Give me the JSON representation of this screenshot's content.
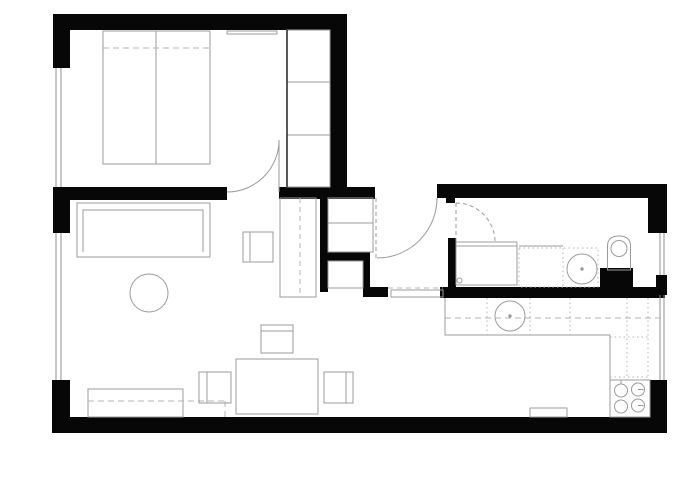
{
  "plan": {
    "canvas": {
      "w": 700,
      "h": 494,
      "bg": "#ffffff"
    },
    "colors": {
      "wall": "#070707",
      "furniture": "#9b9b9b",
      "dashed": "#b4b4b4",
      "dark": "#2e2e2e",
      "window": "#8f8f8f",
      "door": "#9a9a9a"
    },
    "items": [
      {
        "name": "wall-top-bedroom",
        "shapes": [
          {
            "t": "rect",
            "x": 53,
            "y": 14,
            "w": 294,
            "h": 16,
            "f": "wall"
          }
        ]
      },
      {
        "name": "wall-left-upper",
        "shapes": [
          {
            "t": "rect",
            "x": 53,
            "y": 14,
            "w": 17,
            "h": 54,
            "f": "wall"
          }
        ]
      },
      {
        "name": "wall-left-pier",
        "shapes": [
          {
            "t": "rect",
            "x": 53,
            "y": 187,
            "w": 17,
            "h": 46,
            "f": "wall"
          }
        ]
      },
      {
        "name": "wall-left-lower",
        "shapes": [
          {
            "t": "rect",
            "x": 52,
            "y": 380,
            "w": 18,
            "h": 53,
            "f": "wall"
          }
        ]
      },
      {
        "name": "wall-bottom",
        "shapes": [
          {
            "t": "rect",
            "x": 53,
            "y": 417,
            "w": 614,
            "h": 16,
            "f": "wall"
          }
        ]
      },
      {
        "name": "wall-bedroom-right",
        "shapes": [
          {
            "t": "rect",
            "x": 330,
            "y": 14,
            "w": 17,
            "h": 178,
            "f": "wall"
          }
        ]
      },
      {
        "name": "wall-bedroom-bottom-west",
        "shapes": [
          {
            "t": "rect",
            "x": 53,
            "y": 187,
            "w": 174,
            "h": 13,
            "f": "wall"
          }
        ]
      },
      {
        "name": "wall-hall-top-west",
        "shapes": [
          {
            "t": "rect",
            "x": 279,
            "y": 187,
            "w": 96,
            "h": 12,
            "f": "wall"
          }
        ]
      },
      {
        "name": "wall-rightwing-top",
        "shapes": [
          {
            "t": "rect",
            "x": 437,
            "y": 184,
            "w": 230,
            "h": 14,
            "f": "wall"
          }
        ]
      },
      {
        "name": "wall-right-upper",
        "shapes": [
          {
            "t": "rect",
            "x": 648,
            "y": 184,
            "w": 19,
            "h": 49,
            "f": "wall"
          }
        ]
      },
      {
        "name": "wall-right-pier",
        "shapes": [
          {
            "t": "rect",
            "x": 656,
            "y": 275,
            "w": 11,
            "h": 20,
            "f": "wall"
          }
        ]
      },
      {
        "name": "wall-right-lower",
        "shapes": [
          {
            "t": "rect",
            "x": 650,
            "y": 380,
            "w": 17,
            "h": 53,
            "f": "wall"
          }
        ]
      },
      {
        "name": "wall-closet-left",
        "shapes": [
          {
            "t": "rect",
            "x": 320,
            "y": 198,
            "w": 8,
            "h": 94,
            "f": "wall"
          }
        ]
      },
      {
        "name": "wall-closet-mid",
        "shapes": [
          {
            "t": "rect",
            "x": 320,
            "y": 252,
            "w": 50,
            "h": 9,
            "f": "wall"
          }
        ]
      },
      {
        "name": "wall-closet-right",
        "shapes": [
          {
            "t": "rect",
            "x": 363,
            "y": 261,
            "w": 7,
            "h": 27,
            "f": "wall"
          }
        ]
      },
      {
        "name": "wall-closet-stub",
        "shapes": [
          {
            "t": "rect",
            "x": 363,
            "y": 287,
            "w": 25,
            "h": 10,
            "f": "wall"
          }
        ]
      },
      {
        "name": "wall-bathroom-bottom",
        "shapes": [
          {
            "t": "rect",
            "x": 440,
            "y": 287,
            "w": 225,
            "h": 11,
            "f": "wall"
          }
        ]
      },
      {
        "name": "wall-bathroom-left",
        "shapes": [
          {
            "t": "rect",
            "x": 448,
            "y": 238,
            "w": 8,
            "h": 49,
            "f": "wall"
          }
        ]
      },
      {
        "name": "wall-entry-jamb",
        "shapes": [
          {
            "t": "rect",
            "x": 446,
            "y": 195,
            "w": 9,
            "h": 8,
            "f": "wall"
          }
        ]
      },
      {
        "name": "wall-toilet-duct",
        "shapes": [
          {
            "t": "rect",
            "x": 600,
            "y": 268,
            "w": 33,
            "h": 20,
            "f": "wall"
          }
        ]
      },
      {
        "name": "window-bedroom-left",
        "shapes": [
          {
            "t": "line",
            "x1": 56,
            "y1": 68,
            "x2": 56,
            "y2": 187,
            "c": "window"
          },
          {
            "t": "line",
            "x1": 61,
            "y1": 68,
            "x2": 61,
            "y2": 187,
            "c": "window"
          }
        ]
      },
      {
        "name": "window-living-left",
        "shapes": [
          {
            "t": "line",
            "x1": 56,
            "y1": 233,
            "x2": 56,
            "y2": 380,
            "c": "window"
          },
          {
            "t": "line",
            "x1": 61,
            "y1": 233,
            "x2": 61,
            "y2": 380,
            "c": "window"
          }
        ]
      },
      {
        "name": "window-bathroom-right",
        "shapes": [
          {
            "t": "line",
            "x1": 660,
            "y1": 233,
            "x2": 660,
            "y2": 275,
            "c": "window"
          },
          {
            "t": "line",
            "x1": 664,
            "y1": 233,
            "x2": 664,
            "y2": 275,
            "c": "window"
          }
        ]
      },
      {
        "name": "window-kitchen-right",
        "shapes": [
          {
            "t": "line",
            "x1": 660,
            "y1": 295,
            "x2": 660,
            "y2": 380,
            "c": "window"
          },
          {
            "t": "line",
            "x1": 664,
            "y1": 295,
            "x2": 664,
            "y2": 380,
            "c": "window"
          }
        ]
      },
      {
        "name": "door-bedroom",
        "shapes": [
          {
            "t": "path",
            "d": "M227,192 A52,52 0 0 0 279,140",
            "c": "door"
          },
          {
            "t": "line",
            "x1": 279,
            "y1": 140,
            "x2": 279,
            "y2": 192,
            "c": "door"
          }
        ]
      },
      {
        "name": "door-entrance",
        "shapes": [
          {
            "t": "path",
            "d": "M437,198 A60,60 0 0 1 377,258",
            "c": "door"
          },
          {
            "t": "line",
            "x1": 376,
            "y1": 198,
            "x2": 376,
            "y2": 258,
            "c": "door",
            "dash": "4,3"
          }
        ]
      },
      {
        "name": "door-bathroom",
        "shapes": [
          {
            "t": "path",
            "d": "M456,203 A39,39 0 0 1 495,242",
            "c": "door",
            "dash": "4,3"
          },
          {
            "t": "line",
            "x1": 456,
            "y1": 203,
            "x2": 456,
            "y2": 242,
            "c": "door",
            "dash": "4,3"
          }
        ]
      },
      {
        "name": "bed-double",
        "shapes": [
          {
            "t": "rect",
            "x": 103,
            "y": 31,
            "w": 107,
            "h": 133
          },
          {
            "t": "line",
            "x1": 156,
            "y1": 31,
            "x2": 156,
            "y2": 164
          },
          {
            "t": "line",
            "x1": 103,
            "y1": 48,
            "x2": 210,
            "y2": 48,
            "dash": "6,4",
            "c": "dashed"
          }
        ]
      },
      {
        "name": "bedroom-shelf",
        "shapes": [
          {
            "t": "rect",
            "x": 227,
            "y": 31,
            "w": 50,
            "h": 3
          }
        ]
      },
      {
        "name": "wardrobe-bedroom",
        "shapes": [
          {
            "t": "rect",
            "x": 287,
            "y": 30,
            "w": 43,
            "h": 157
          },
          {
            "t": "line",
            "x1": 287,
            "y1": 82,
            "x2": 330,
            "y2": 82
          },
          {
            "t": "line",
            "x1": 287,
            "y1": 135,
            "x2": 330,
            "y2": 135
          },
          {
            "t": "line",
            "x1": 287,
            "y1": 30,
            "x2": 287,
            "y2": 187,
            "c": "dark",
            "sw": 1.6
          }
        ]
      },
      {
        "name": "sideboard-living",
        "shapes": [
          {
            "t": "rect",
            "x": 77,
            "y": 203,
            "w": 133,
            "h": 54
          },
          {
            "t": "path",
            "d": "M83,252 L83,210 L203,210 L203,252"
          }
        ]
      },
      {
        "name": "armchair-living",
        "shapes": [
          {
            "t": "rect",
            "x": 243,
            "y": 232,
            "w": 30,
            "h": 30
          },
          {
            "t": "line",
            "x1": 250,
            "y1": 232,
            "x2": 250,
            "y2": 262
          }
        ]
      },
      {
        "name": "coffee-table-round",
        "shapes": [
          {
            "t": "circle",
            "cx": 149,
            "cy": 293,
            "r": 19
          }
        ]
      },
      {
        "name": "wardrobe-tall-living",
        "shapes": [
          {
            "t": "rect",
            "x": 280,
            "y": 198,
            "w": 36,
            "h": 99
          },
          {
            "t": "line",
            "x1": 300,
            "y1": 198,
            "x2": 300,
            "y2": 297,
            "dash": "5,4",
            "c": "dashed"
          }
        ]
      },
      {
        "name": "closet-upper-shelves",
        "shapes": [
          {
            "t": "rect",
            "x": 328,
            "y": 198,
            "w": 45,
            "h": 54
          },
          {
            "t": "line",
            "x1": 328,
            "y1": 223,
            "x2": 373,
            "y2": 223
          }
        ]
      },
      {
        "name": "closet-lower-cabinet",
        "shapes": [
          {
            "t": "rect",
            "x": 328,
            "y": 261,
            "w": 35,
            "h": 27
          }
        ]
      },
      {
        "name": "hall-threshold",
        "shapes": [
          {
            "t": "rect",
            "x": 391,
            "y": 290,
            "w": 52,
            "h": 7
          },
          {
            "t": "line",
            "x1": 388,
            "y1": 288,
            "x2": 443,
            "y2": 288,
            "dash": "5,4",
            "c": "dashed"
          }
        ]
      },
      {
        "name": "sofa",
        "shapes": [
          {
            "t": "rect",
            "x": 88,
            "y": 389,
            "w": 95,
            "h": 28
          },
          {
            "t": "line",
            "x1": 88,
            "y1": 401,
            "x2": 225,
            "y2": 401,
            "dash": "6,4",
            "c": "dashed"
          },
          {
            "t": "line",
            "x1": 225,
            "y1": 401,
            "x2": 225,
            "y2": 417,
            "dash": "6,4",
            "c": "dashed"
          }
        ]
      },
      {
        "name": "dining-table",
        "shapes": [
          {
            "t": "rect",
            "x": 236,
            "y": 359,
            "w": 82,
            "h": 55
          }
        ]
      },
      {
        "name": "chair-north",
        "shapes": [
          {
            "t": "rect",
            "x": 261,
            "y": 325,
            "w": 32,
            "h": 28
          },
          {
            "t": "line",
            "x1": 261,
            "y1": 331,
            "x2": 293,
            "y2": 331
          }
        ]
      },
      {
        "name": "chair-west",
        "shapes": [
          {
            "t": "rect",
            "x": 199,
            "y": 372,
            "w": 32,
            "h": 31
          },
          {
            "t": "line",
            "x1": 207,
            "y1": 372,
            "x2": 207,
            "y2": 403
          }
        ]
      },
      {
        "name": "chair-east",
        "shapes": [
          {
            "t": "rect",
            "x": 324,
            "y": 372,
            "w": 29,
            "h": 31
          },
          {
            "t": "line",
            "x1": 346,
            "y1": 372,
            "x2": 346,
            "y2": 403
          }
        ]
      },
      {
        "name": "washing-machine",
        "shapes": [
          {
            "t": "rect",
            "x": 456,
            "y": 242,
            "w": 61,
            "h": 43
          },
          {
            "t": "line",
            "x1": 456,
            "y1": 246,
            "x2": 517,
            "y2": 246
          },
          {
            "t": "circle",
            "cx": 459.5,
            "cy": 280.5,
            "r": 2.5
          }
        ]
      },
      {
        "name": "bathroom-vanity",
        "shapes": [
          {
            "t": "rect",
            "x": 519,
            "y": 248,
            "w": 79,
            "h": 39,
            "dash": "1.5,3",
            "c": "dashed"
          },
          {
            "t": "line",
            "x1": 519,
            "y1": 246,
            "x2": 563,
            "y2": 246
          },
          {
            "t": "line",
            "x1": 563,
            "y1": 248,
            "x2": 563,
            "y2": 287,
            "dash": "1.5,3",
            "c": "dashed"
          },
          {
            "t": "circle",
            "cx": 582,
            "cy": 269,
            "r": 15
          },
          {
            "t": "circle",
            "cx": 582,
            "cy": 269,
            "r": 1.2,
            "f": "#9b9b9b"
          }
        ]
      },
      {
        "name": "toilet",
        "shapes": [
          {
            "t": "path",
            "d": "M607.5,270 L607.5,246 Q607.5,236 619,236 Q630.5,236 630.5,246 L630.5,270 Z"
          },
          {
            "t": "circle",
            "cx": 619,
            "cy": 248.5,
            "r": 8
          }
        ]
      },
      {
        "name": "kitchen-counter",
        "shapes": [
          {
            "t": "path",
            "d": "M445,298 L445,335 L610,335 L610,380"
          },
          {
            "t": "line",
            "x1": 648,
            "y1": 298,
            "x2": 648,
            "y2": 380,
            "dash": "1.5,3",
            "c": "dashed"
          },
          {
            "t": "line",
            "x1": 610,
            "y1": 337,
            "x2": 648,
            "y2": 337,
            "dash": "1.5,3",
            "c": "dashed"
          },
          {
            "t": "line",
            "x1": 610,
            "y1": 377,
            "x2": 648,
            "y2": 377,
            "dash": "1.5,3",
            "c": "dashed"
          },
          {
            "t": "line",
            "x1": 487,
            "y1": 298,
            "x2": 487,
            "y2": 335,
            "dash": "1.5,3",
            "c": "dashed"
          },
          {
            "t": "line",
            "x1": 530,
            "y1": 298,
            "x2": 530,
            "y2": 335,
            "dash": "1.5,3",
            "c": "dashed"
          },
          {
            "t": "line",
            "x1": 570,
            "y1": 298,
            "x2": 570,
            "y2": 335,
            "dash": "1.5,3",
            "c": "dashed"
          },
          {
            "t": "line",
            "x1": 627,
            "y1": 298,
            "x2": 627,
            "y2": 380,
            "dash": "1.5,3",
            "c": "dashed"
          },
          {
            "t": "line",
            "x1": 445,
            "y1": 318,
            "x2": 661,
            "y2": 318,
            "dash": "6,4",
            "c": "dashed"
          }
        ]
      },
      {
        "name": "kitchen-sink",
        "shapes": [
          {
            "t": "circle",
            "cx": 510,
            "cy": 316,
            "r": 15
          },
          {
            "t": "circle",
            "cx": 510,
            "cy": 316,
            "r": 1.2,
            "f": "#9b9b9b"
          }
        ]
      },
      {
        "name": "stove",
        "shapes": [
          {
            "t": "rect",
            "x": 610,
            "y": 380,
            "w": 40,
            "h": 37
          },
          {
            "t": "circle",
            "cx": 621,
            "cy": 390.5,
            "r": 6.5
          },
          {
            "t": "circle",
            "cx": 638,
            "cy": 389.5,
            "r": 6.5
          },
          {
            "t": "circle",
            "cx": 621,
            "cy": 406.5,
            "r": 6.5
          },
          {
            "t": "circle",
            "cx": 638,
            "cy": 405.5,
            "r": 6.5
          },
          {
            "t": "line",
            "x1": 621,
            "y1": 380,
            "x2": 621,
            "y2": 384,
            "c": "furniture"
          },
          {
            "t": "line",
            "x1": 638,
            "y1": 389.5,
            "x2": 643.5,
            "y2": 389.5,
            "c": "furniture"
          },
          {
            "t": "line",
            "x1": 638,
            "y1": 405.5,
            "x2": 643.5,
            "y2": 405.5,
            "c": "furniture"
          }
        ]
      },
      {
        "name": "floor-mat",
        "shapes": [
          {
            "t": "rect",
            "x": 530,
            "y": 408,
            "w": 37,
            "h": 9
          }
        ]
      }
    ]
  }
}
